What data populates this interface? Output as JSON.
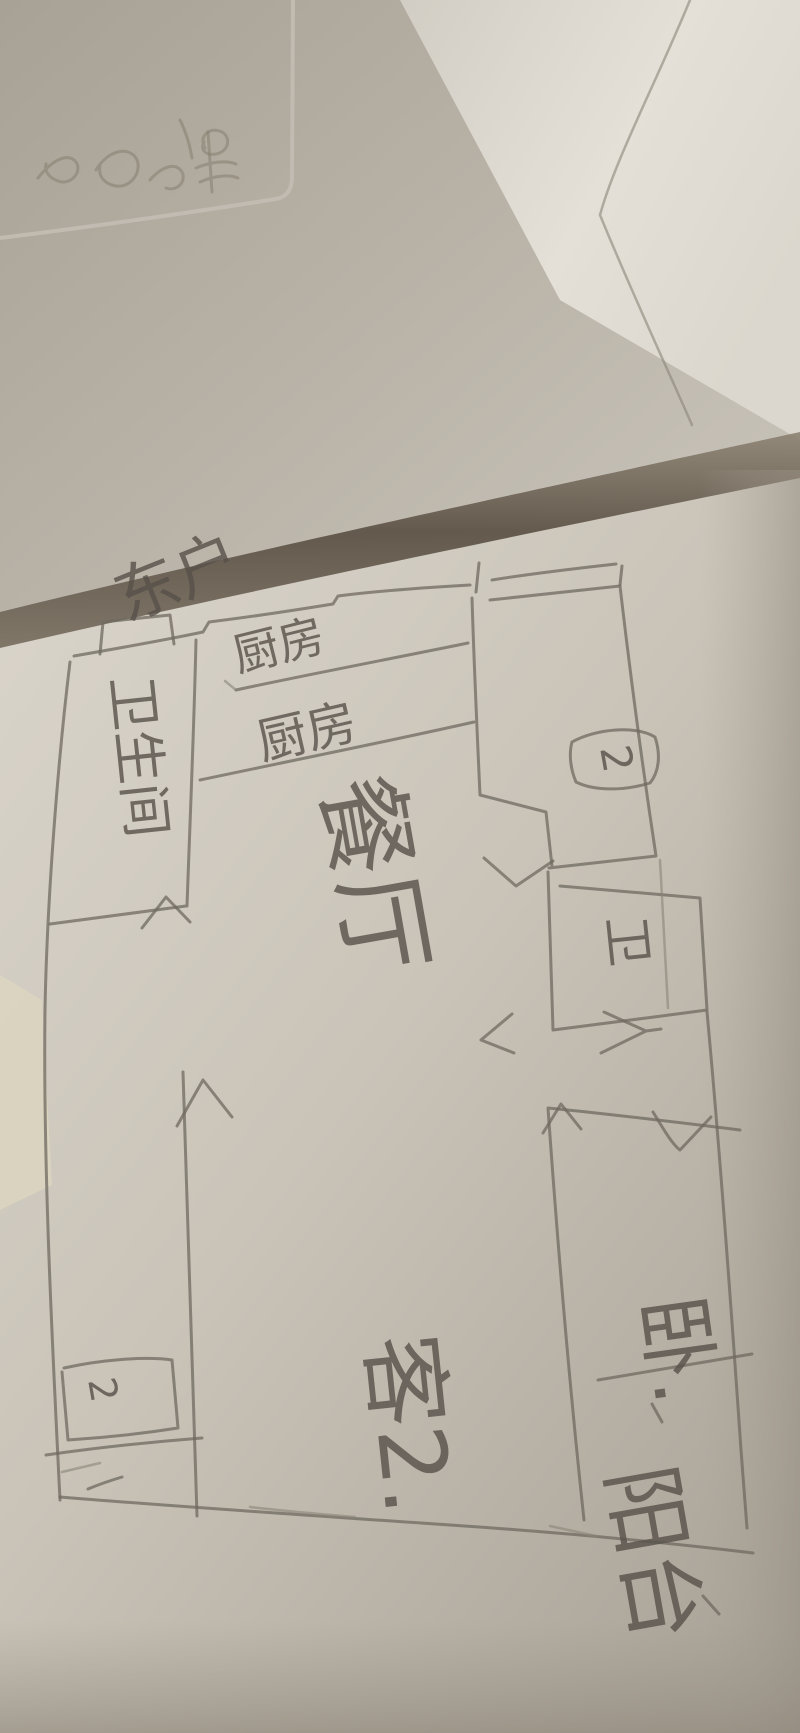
{
  "labels": {
    "unit": "东户",
    "kitchen": "厨房",
    "kitchen_band": "厨房",
    "dining": "餐厅",
    "bathroom": "卫生间",
    "toilet": "卫",
    "bedroom_top_number": "2",
    "bedroom_right": "卧.",
    "living": "客2.",
    "bedroom_left_number": "2",
    "balcony": "阳台"
  },
  "colors": {
    "paper_light": "#d8d3c9",
    "paper_mid": "#c5bfb4",
    "paper_dark": "#a9a297",
    "upper_sheet": "#b5afa4",
    "upper_sheet_bright": "#e4e0d8",
    "fold_shadow": "#5e5447",
    "pencil": "#6f6960",
    "handwriting": "#57514a"
  }
}
